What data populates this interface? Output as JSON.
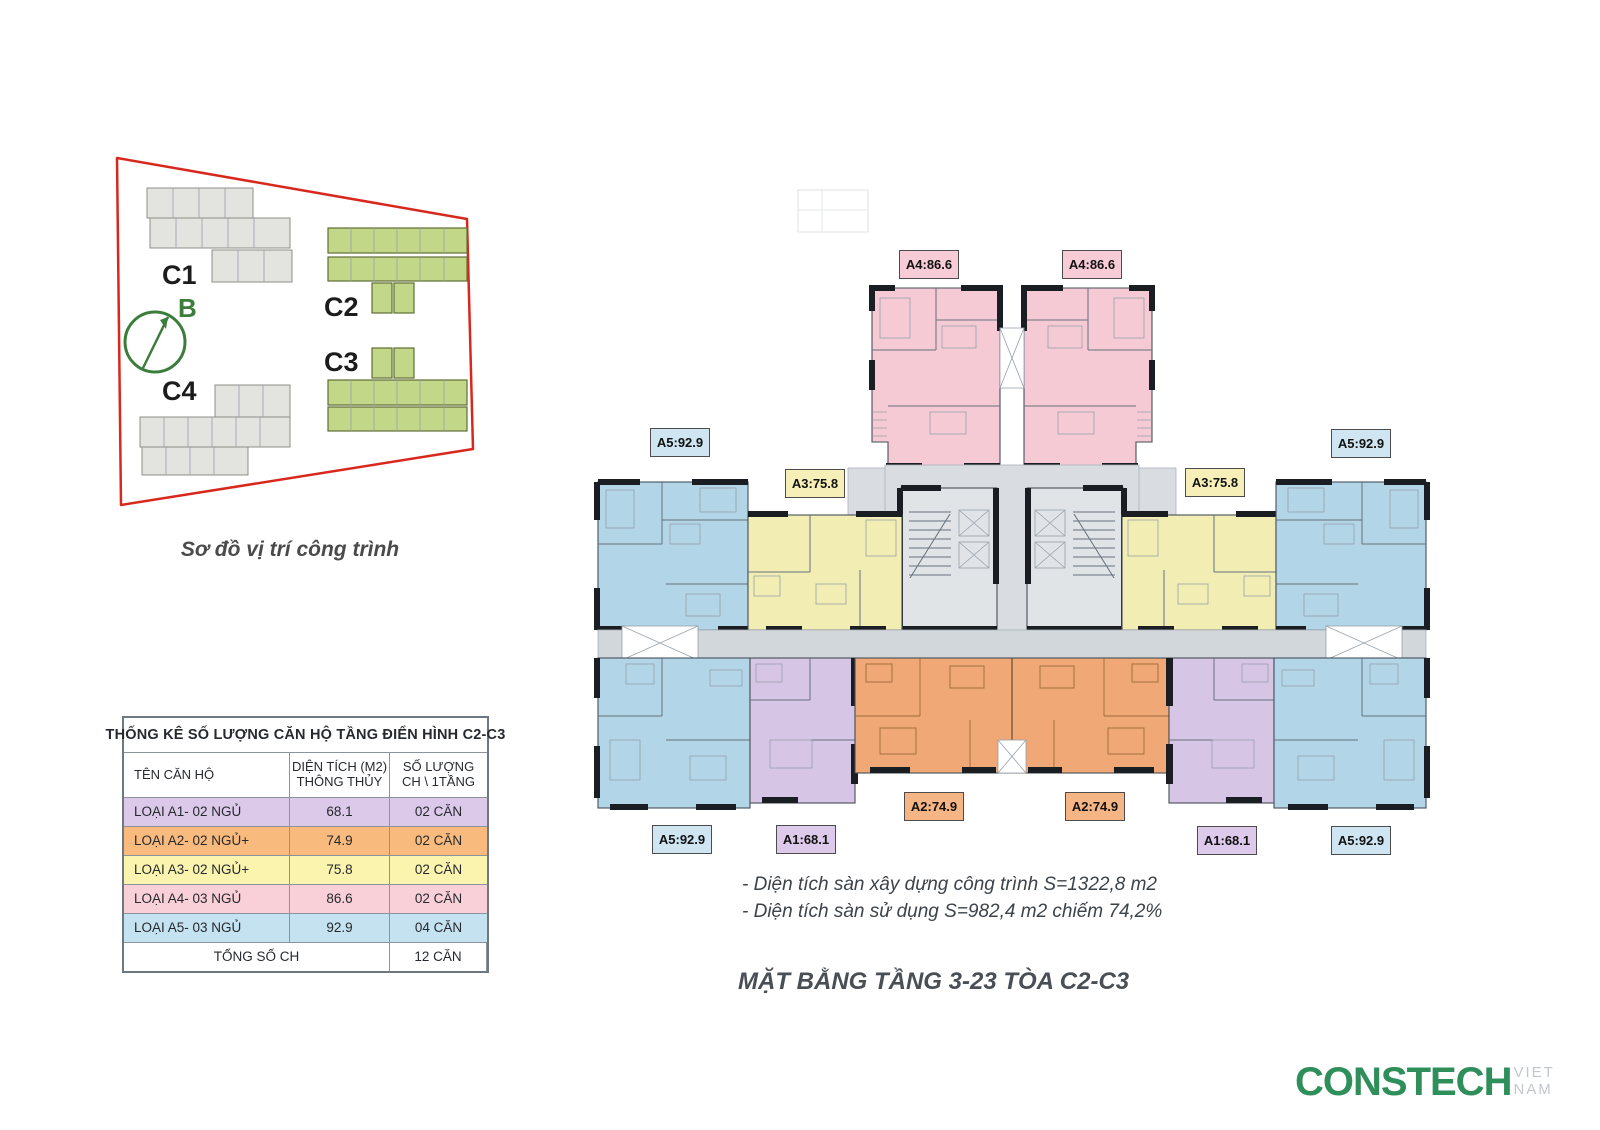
{
  "site_plan": {
    "caption": "Sơ đồ vị trí công trình",
    "compass_label": "B",
    "buildings": [
      {
        "id": "C1",
        "color": "gray"
      },
      {
        "id": "C2",
        "color": "green"
      },
      {
        "id": "C3",
        "color": "green"
      },
      {
        "id": "C4",
        "color": "gray"
      }
    ]
  },
  "table": {
    "title": "THỐNG KÊ SỐ LƯỢNG CĂN HỘ TẦNG ĐIỂN HÌNH C2-C3",
    "headers": {
      "col1": "TÊN CĂN HỘ",
      "col2_line1": "DIỆN TÍCH (M2)",
      "col2_line2": "THÔNG THỦY",
      "col3_line1": "SỐ LƯỢNG",
      "col3_line2": "CH \\ 1TẦNG"
    },
    "rows": [
      {
        "name": "LOẠI A1- 02 NGỦ",
        "area": "68.1",
        "count": "02 CĂN",
        "color": "#dcc9ea"
      },
      {
        "name": "LOẠI A2- 02 NGỦ+",
        "area": "74.9",
        "count": "02 CĂN",
        "color": "#f9ba7d"
      },
      {
        "name": "LOẠI A3- 02 NGỦ+",
        "area": "75.8",
        "count": "02 CĂN",
        "color": "#faf4ae"
      },
      {
        "name": "LOẠI A4- 03 NGỦ",
        "area": "86.6",
        "count": "02 CĂN",
        "color": "#fad0d8"
      },
      {
        "name": "LOẠI A5- 03 NGỦ",
        "area": "92.9",
        "count": "04 CĂN",
        "color": "#c5e2f0"
      }
    ],
    "total_label": "TỔNG SỐ CH",
    "total_value": "12 CĂN"
  },
  "floor_plan": {
    "title": "MẶT BẰNG TẦNG 3-23 TÒA C2-C3",
    "notes": [
      "- Diện tích sàn xây dựng công trình S=1322,8 m2",
      "- Diện tích sàn sử dụng S=982,4 m2 chiếm 74,2%"
    ],
    "unit_labels": [
      {
        "id": "a4-left",
        "text": "A4:86.6",
        "color": "pink"
      },
      {
        "id": "a4-right",
        "text": "A4:86.6",
        "color": "pink"
      },
      {
        "id": "a5-top-left",
        "text": "A5:92.9",
        "color": "blue"
      },
      {
        "id": "a5-top-right",
        "text": "A5:92.9",
        "color": "blue"
      },
      {
        "id": "a3-left",
        "text": "A3:75.8",
        "color": "yellow"
      },
      {
        "id": "a3-right",
        "text": "A3:75.8",
        "color": "yellow"
      },
      {
        "id": "a2-left",
        "text": "A2:74.9",
        "color": "orange"
      },
      {
        "id": "a2-right",
        "text": "A2:74.9",
        "color": "orange"
      },
      {
        "id": "a5-bottom-left",
        "text": "A5:92.9",
        "color": "blue"
      },
      {
        "id": "a1-bottom-left",
        "text": "A1:68.1",
        "color": "purple"
      },
      {
        "id": "a1-bottom-right",
        "text": "A1:68.1",
        "color": "purple"
      },
      {
        "id": "a5-bottom-right",
        "text": "A5:92.9",
        "color": "blue"
      }
    ]
  },
  "logo": {
    "brand": "CONSTECH",
    "suffix": "VIET NAM"
  },
  "colors": {
    "a1_purple": "#d7c5e6",
    "a2_orange": "#f0a876",
    "a3_yellow": "#f2edb3",
    "a4_pink": "#f5cad4",
    "a5_blue": "#b2d5e8",
    "outline_red": "#d8281e",
    "building_green": "#c3d789",
    "logo_green": "#2f8f5b",
    "core_gray": "#d9dde1"
  }
}
